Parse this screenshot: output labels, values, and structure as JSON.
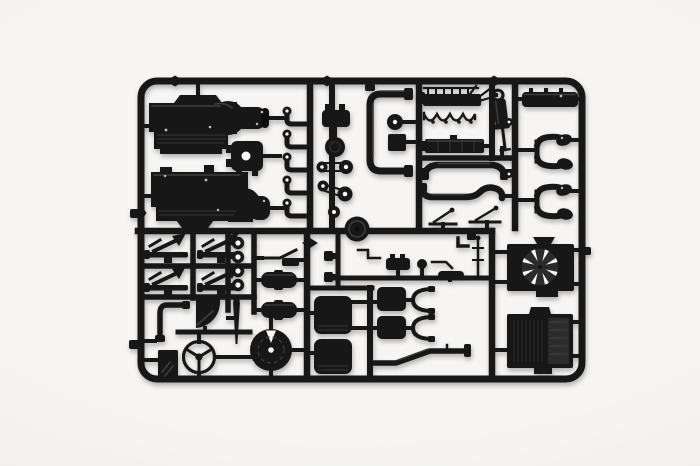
{
  "photo": {
    "subject": "Black injection-molded plastic model kit sprue (parts tree) with truck engine and chassis parts, photographed on a plain white background",
    "colors": {
      "bg": "#f6f5f3",
      "bgEdge": "#eceae7",
      "plastic": "#171717",
      "plasticDeep": "#0d0d0d",
      "plasticMid": "#2b2b2b",
      "plasticHighlight": "#3e3e3e",
      "hole": "#f8f7f5",
      "shadow": "rgba(20,20,20,0.30)"
    },
    "parts": [
      {
        "id": "engine-block-half-upper",
        "label": "engine block half",
        "count": 1
      },
      {
        "id": "engine-block-half-lower",
        "label": "engine block half",
        "count": 1
      },
      {
        "id": "gearbox-housing",
        "label": "gearbox housing with centre bore",
        "count": 1
      },
      {
        "id": "elbow-fittings",
        "label": "pipe elbow fittings",
        "count": 5
      },
      {
        "id": "distributor",
        "label": "distributor / pump body",
        "count": 1
      },
      {
        "id": "pulleys-and-belts",
        "label": "pulleys and belt tensioners",
        "count": 5
      },
      {
        "id": "clutch-hub",
        "label": "round clutch hub",
        "count": 1
      },
      {
        "id": "coolant-c-pipe",
        "label": "large C-shaped coolant pipe",
        "count": 1
      },
      {
        "id": "rocker-assembly",
        "label": "rocker arm assembly",
        "count": 1
      },
      {
        "id": "gasket-garland",
        "label": "looped harness strip",
        "count": 1
      },
      {
        "id": "intake-manifold",
        "label": "intake manifold block",
        "count": 1
      },
      {
        "id": "long-exhaust-pipes",
        "label": "long exhaust pipes",
        "count": 2
      },
      {
        "id": "gear-levers",
        "label": "lever parts",
        "count": 2
      },
      {
        "id": "shock-absorber",
        "label": "shock absorber",
        "count": 1
      },
      {
        "id": "valve-cover",
        "label": "valve cover bar",
        "count": 1
      },
      {
        "id": "turbo-elbow-pairs",
        "label": "paired turbo exhaust elbows",
        "count": 2
      },
      {
        "id": "leaf-springs",
        "label": "leaf springs with shackle arrows",
        "count": 4
      },
      {
        "id": "bushing-rings",
        "label": "ring bushings",
        "count": 4
      },
      {
        "id": "air-tanks",
        "label": "cylindrical air tanks",
        "count": 2
      },
      {
        "id": "mounting-bracket",
        "label": "mounting bracket",
        "count": 1
      },
      {
        "id": "l-coolant-pipe",
        "label": "L-shaped pipe",
        "count": 1
      },
      {
        "id": "mud-flap",
        "label": "mud flap",
        "count": 1
      },
      {
        "id": "fender-quarter",
        "label": "quarter fender panel",
        "count": 1
      },
      {
        "id": "steering-wheel",
        "label": "three-spoke steering wheel",
        "count": 1
      },
      {
        "id": "gear-stick",
        "label": "tapered gear stick",
        "count": 1
      },
      {
        "id": "brake-drum",
        "label": "brake drum / flywheel with notch",
        "count": 1
      },
      {
        "id": "seat-cushions",
        "label": "seat cushions",
        "count": 2
      },
      {
        "id": "seat-backrests",
        "label": "seat backrests",
        "count": 2
      },
      {
        "id": "seat-frames",
        "label": "seat frame brackets",
        "count": 2
      },
      {
        "id": "chassis-exhaust-pipe",
        "label": "bent chassis exhaust pipe",
        "count": 1
      },
      {
        "id": "small-fittings",
        "label": "assorted small fittings",
        "count": 10
      },
      {
        "id": "radiator-fan",
        "label": "radiator fan in shroud, 8 blades",
        "count": 1
      },
      {
        "id": "radiator-core",
        "label": "radiator core",
        "count": 1
      }
    ]
  }
}
